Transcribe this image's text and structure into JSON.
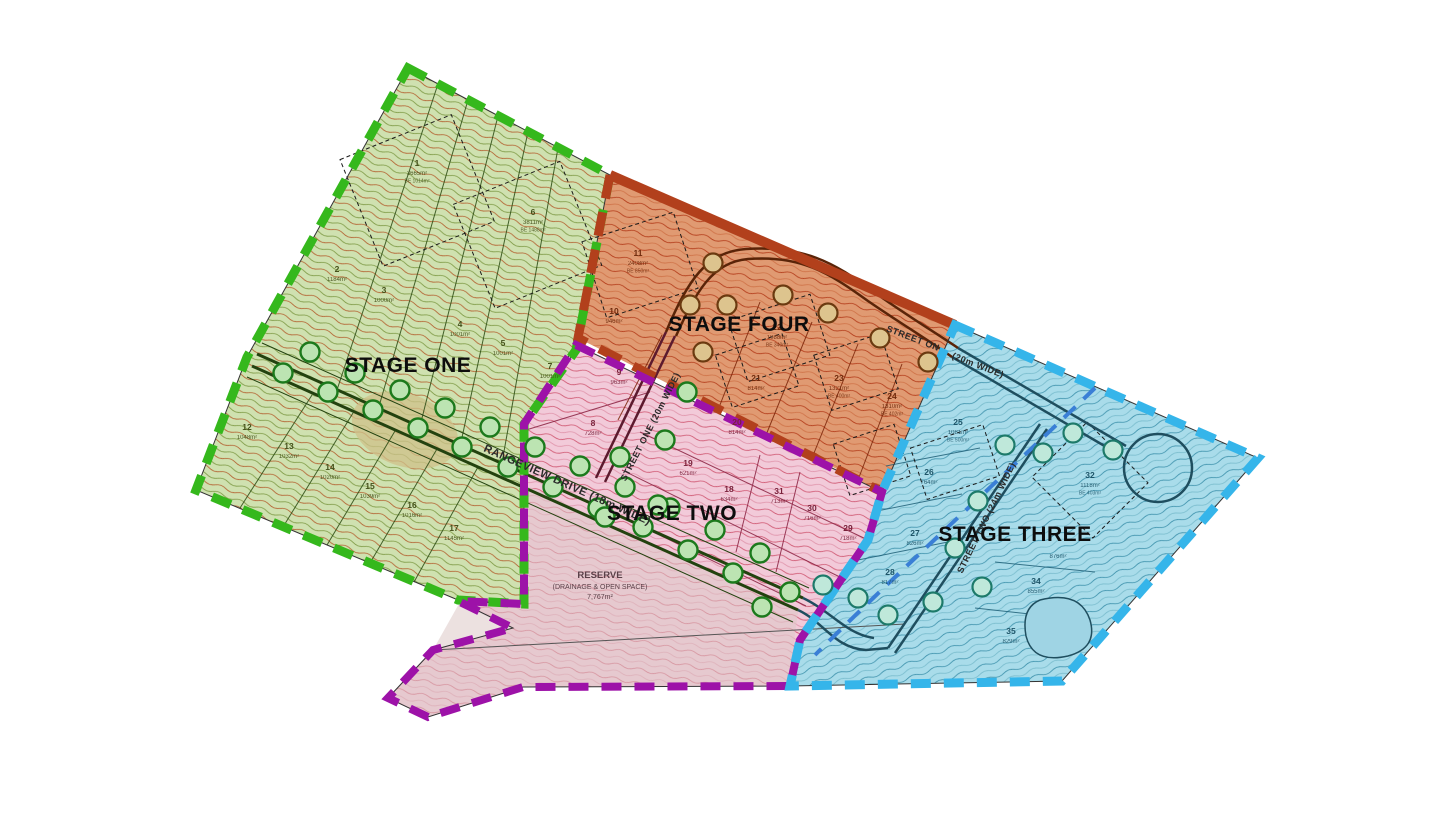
{
  "plan": {
    "stage_labels": [
      {
        "id": "stage-one",
        "label": "STAGE ONE",
        "x": 408,
        "y": 372
      },
      {
        "id": "stage-two",
        "label": "STAGE TWO",
        "x": 672,
        "y": 520
      },
      {
        "id": "stage-three",
        "label": "STAGE THREE",
        "x": 1015,
        "y": 541
      },
      {
        "id": "stage-four",
        "label": "STAGE FOUR",
        "x": 739,
        "y": 331
      }
    ],
    "stage_colors": {
      "stage_one_boundary": "#35b81c",
      "stage_two_boundary": "#9d12a8",
      "stage_three_boundary": "#35b5ea",
      "stage_four_boundary": "#b2401c"
    },
    "streets": [
      {
        "label": "RANGEVIEW DRIVE (18m WIDE)",
        "x": 566,
        "y": 488,
        "rotate": 24,
        "size": 11
      },
      {
        "label": "STREET ONE (20m WIDE)",
        "x": 653,
        "y": 428,
        "rotate": -63,
        "size": 9
      },
      {
        "label": "STREET ON",
        "x": 912,
        "y": 341,
        "rotate": 21,
        "size": 9
      },
      {
        "label": "(20m WIDE)",
        "x": 977,
        "y": 368,
        "rotate": 21,
        "size": 9
      },
      {
        "label": "STREET TWO (24m WIDE)",
        "x": 989,
        "y": 519,
        "rotate": -64,
        "size": 9
      }
    ],
    "reserve": {
      "line1": "RESERVE",
      "line2": "(DRAINAGE & OPEN SPACE)",
      "line3": "7,767m²",
      "x": 600,
      "y": 578
    },
    "lots": [
      {
        "n": "1",
        "area": "3665m²",
        "be": "BE 1014m²",
        "x": 417,
        "y": 166,
        "stage": "s1"
      },
      {
        "n": "2",
        "area": "1184m²",
        "be": "",
        "x": 337,
        "y": 272,
        "stage": "s1"
      },
      {
        "n": "3",
        "area": "1000m²",
        "be": "",
        "x": 384,
        "y": 293,
        "stage": "s1"
      },
      {
        "n": "4",
        "area": "1001m²",
        "be": "",
        "x": 460,
        "y": 327,
        "stage": "s1"
      },
      {
        "n": "5",
        "area": "1001m²",
        "be": "",
        "x": 503,
        "y": 346,
        "stage": "s1"
      },
      {
        "n": "6",
        "area": "3811m²",
        "be": "BE 1488m²",
        "x": 533,
        "y": 215,
        "stage": "s1"
      },
      {
        "n": "7",
        "area": "1001m²",
        "be": "",
        "x": 550,
        "y": 369,
        "stage": "s1"
      },
      {
        "n": "12",
        "area": "1048m²",
        "be": "",
        "x": 247,
        "y": 430,
        "stage": "s1"
      },
      {
        "n": "13",
        "area": "1032m²",
        "be": "",
        "x": 289,
        "y": 449,
        "stage": "s1"
      },
      {
        "n": "14",
        "area": "1020m²",
        "be": "",
        "x": 330,
        "y": 470,
        "stage": "s1"
      },
      {
        "n": "15",
        "area": "1039m²",
        "be": "",
        "x": 370,
        "y": 489,
        "stage": "s1"
      },
      {
        "n": "16",
        "area": "1016m²",
        "be": "",
        "x": 412,
        "y": 508,
        "stage": "s1"
      },
      {
        "n": "17",
        "area": "1145m²",
        "be": "",
        "x": 454,
        "y": 531,
        "stage": "s1"
      },
      {
        "n": "8",
        "area": "728m²",
        "be": "",
        "x": 593,
        "y": 426,
        "stage": "s2"
      },
      {
        "n": "9",
        "area": "963m²",
        "be": "",
        "x": 619,
        "y": 375,
        "stage": "s2"
      },
      {
        "n": "18",
        "area": "634m²",
        "be": "",
        "x": 729,
        "y": 492,
        "stage": "s2"
      },
      {
        "n": "19",
        "area": "621m²",
        "be": "",
        "x": 688,
        "y": 466,
        "stage": "s2"
      },
      {
        "n": "20",
        "area": "814m²",
        "be": "",
        "x": 737,
        "y": 425,
        "stage": "s2"
      },
      {
        "n": "29",
        "area": "718m²",
        "be": "",
        "x": 848,
        "y": 531,
        "stage": "s2"
      },
      {
        "n": "30",
        "area": "716m²",
        "be": "",
        "x": 812,
        "y": 511,
        "stage": "s2"
      },
      {
        "n": "31",
        "area": "713m²",
        "be": "",
        "x": 779,
        "y": 494,
        "stage": "s2"
      },
      {
        "n": "10",
        "area": "946m²",
        "be": "",
        "x": 614,
        "y": 314,
        "stage": "s4"
      },
      {
        "n": "11",
        "area": "2408m²",
        "be": "BE 850m²",
        "x": 638,
        "y": 256,
        "stage": "s4"
      },
      {
        "n": "21",
        "area": "814m²",
        "be": "",
        "x": 756,
        "y": 381,
        "stage": "s4"
      },
      {
        "n": "22",
        "area": "1088m²",
        "be": "BE 340m²",
        "x": 777,
        "y": 330,
        "stage": "s4"
      },
      {
        "n": "23",
        "area": "1321m²",
        "be": "BE 400m²",
        "x": 839,
        "y": 381,
        "stage": "s4"
      },
      {
        "n": "24",
        "area": "1310m²",
        "be": "BE 402m²",
        "x": 892,
        "y": 399,
        "stage": "s4"
      },
      {
        "n": "25",
        "area": "1081m²",
        "be": "BE 500m²",
        "x": 958,
        "y": 425,
        "stage": "s3"
      },
      {
        "n": "26",
        "area": "764m²",
        "be": "",
        "x": 929,
        "y": 475,
        "stage": "s3"
      },
      {
        "n": "27",
        "area": "826m²",
        "be": "",
        "x": 915,
        "y": 536,
        "stage": "s3"
      },
      {
        "n": "28",
        "area": "817m²",
        "be": "",
        "x": 890,
        "y": 575,
        "stage": "s3"
      },
      {
        "n": "32",
        "area": "1118m²",
        "be": "BE 403m²",
        "x": 1090,
        "y": 478,
        "stage": "s3"
      },
      {
        "n": "",
        "area": "876m²",
        "be": "",
        "x": 1058,
        "y": 549,
        "stage": "s3"
      },
      {
        "n": "34",
        "area": "855m²",
        "be": "",
        "x": 1036,
        "y": 584,
        "stage": "s3"
      },
      {
        "n": "35",
        "area": "829m²",
        "be": "",
        "x": 1011,
        "y": 634,
        "stage": "s3"
      }
    ],
    "trees": [
      {
        "t": "green",
        "x": 310,
        "y": 352
      },
      {
        "t": "green",
        "x": 283,
        "y": 373
      },
      {
        "t": "green",
        "x": 355,
        "y": 373
      },
      {
        "t": "green",
        "x": 328,
        "y": 392
      },
      {
        "t": "green",
        "x": 400,
        "y": 390
      },
      {
        "t": "green",
        "x": 373,
        "y": 410
      },
      {
        "t": "green",
        "x": 445,
        "y": 408
      },
      {
        "t": "green",
        "x": 418,
        "y": 428
      },
      {
        "t": "green",
        "x": 490,
        "y": 427
      },
      {
        "t": "green",
        "x": 462,
        "y": 447
      },
      {
        "t": "green",
        "x": 535,
        "y": 447
      },
      {
        "t": "green",
        "x": 508,
        "y": 467
      },
      {
        "t": "green",
        "x": 580,
        "y": 466
      },
      {
        "t": "green",
        "x": 553,
        "y": 487
      },
      {
        "t": "green",
        "x": 625,
        "y": 487
      },
      {
        "t": "green",
        "x": 598,
        "y": 508
      },
      {
        "t": "green",
        "x": 670,
        "y": 508
      },
      {
        "t": "green",
        "x": 643,
        "y": 527
      },
      {
        "t": "green",
        "x": 715,
        "y": 530
      },
      {
        "t": "green",
        "x": 688,
        "y": 550
      },
      {
        "t": "green",
        "x": 760,
        "y": 553
      },
      {
        "t": "green",
        "x": 733,
        "y": 573
      },
      {
        "t": "green",
        "x": 790,
        "y": 592
      },
      {
        "t": "green",
        "x": 762,
        "y": 607
      },
      {
        "t": "green",
        "x": 687,
        "y": 392
      },
      {
        "t": "green",
        "x": 665,
        "y": 440
      },
      {
        "t": "green",
        "x": 620,
        "y": 457
      },
      {
        "t": "green",
        "x": 658,
        "y": 505
      },
      {
        "t": "green",
        "x": 605,
        "y": 517
      },
      {
        "t": "tan",
        "x": 713,
        "y": 263
      },
      {
        "t": "tan",
        "x": 690,
        "y": 305
      },
      {
        "t": "tan",
        "x": 727,
        "y": 305
      },
      {
        "t": "tan",
        "x": 783,
        "y": 295
      },
      {
        "t": "tan",
        "x": 828,
        "y": 313
      },
      {
        "t": "tan",
        "x": 880,
        "y": 338
      },
      {
        "t": "tan",
        "x": 928,
        "y": 362
      },
      {
        "t": "tan",
        "x": 703,
        "y": 352
      },
      {
        "t": "teal",
        "x": 1005,
        "y": 445
      },
      {
        "t": "teal",
        "x": 1043,
        "y": 453
      },
      {
        "t": "teal",
        "x": 1073,
        "y": 433
      },
      {
        "t": "teal",
        "x": 1113,
        "y": 450
      },
      {
        "t": "teal",
        "x": 978,
        "y": 501
      },
      {
        "t": "teal",
        "x": 955,
        "y": 548
      },
      {
        "t": "teal",
        "x": 933,
        "y": 602
      },
      {
        "t": "teal",
        "x": 982,
        "y": 587
      },
      {
        "t": "teal",
        "x": 888,
        "y": 615
      },
      {
        "t": "teal",
        "x": 858,
        "y": 598
      },
      {
        "t": "teal",
        "x": 823,
        "y": 585
      }
    ]
  }
}
